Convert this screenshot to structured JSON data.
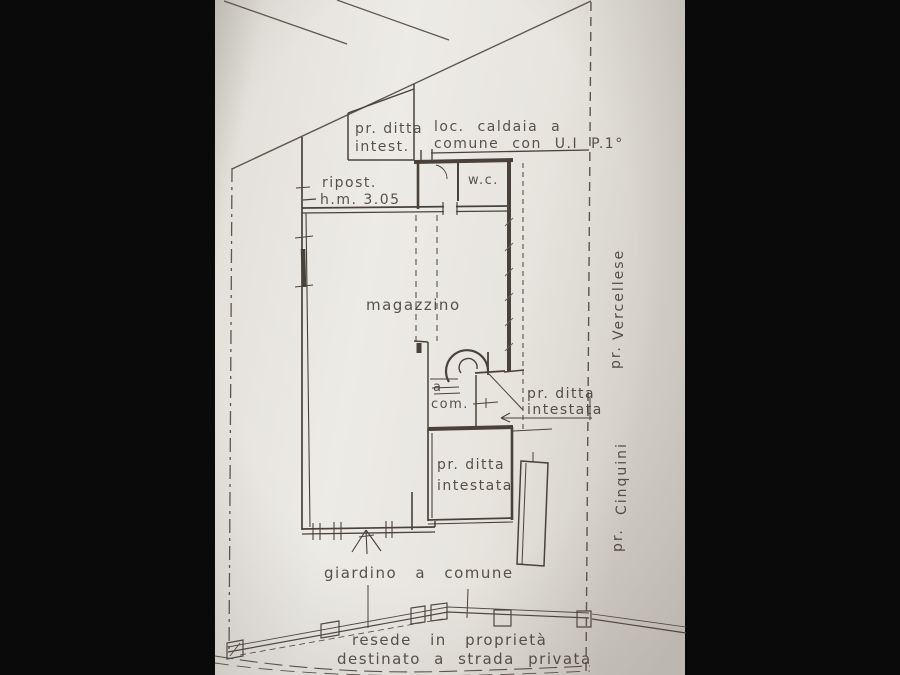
{
  "plan": {
    "owner_box": {
      "line1": "pr. ditta",
      "line2": "intest."
    },
    "boiler_room": {
      "line1": "loc. caldaia a",
      "line2": "comune con U.I P.1°"
    },
    "storage": {
      "line1": "ripost.",
      "line2": "h.m. 3.05"
    },
    "wc_label": "w.c.",
    "warehouse_label": "magazzino",
    "stair_common": {
      "line1": "a",
      "line2": "com."
    },
    "stair_owner": {
      "line1": "pr. ditta",
      "line2": "intestata"
    },
    "room_owner": {
      "line1": "pr. ditta",
      "line2": "intestata"
    },
    "garden_label": "giardino a comune",
    "neighbor_right_top": {
      "prefix": "pr.",
      "name": "Vercellese"
    },
    "neighbor_right_bottom": {
      "prefix": "pr.",
      "name": "Cinquini"
    },
    "road_note": {
      "line1": "resede in proprietà",
      "line2": "destinato a strada privata"
    }
  },
  "colors": {
    "background": "#0a0a0a",
    "paper": "#e9e6e0",
    "ink": "#4a4239"
  }
}
